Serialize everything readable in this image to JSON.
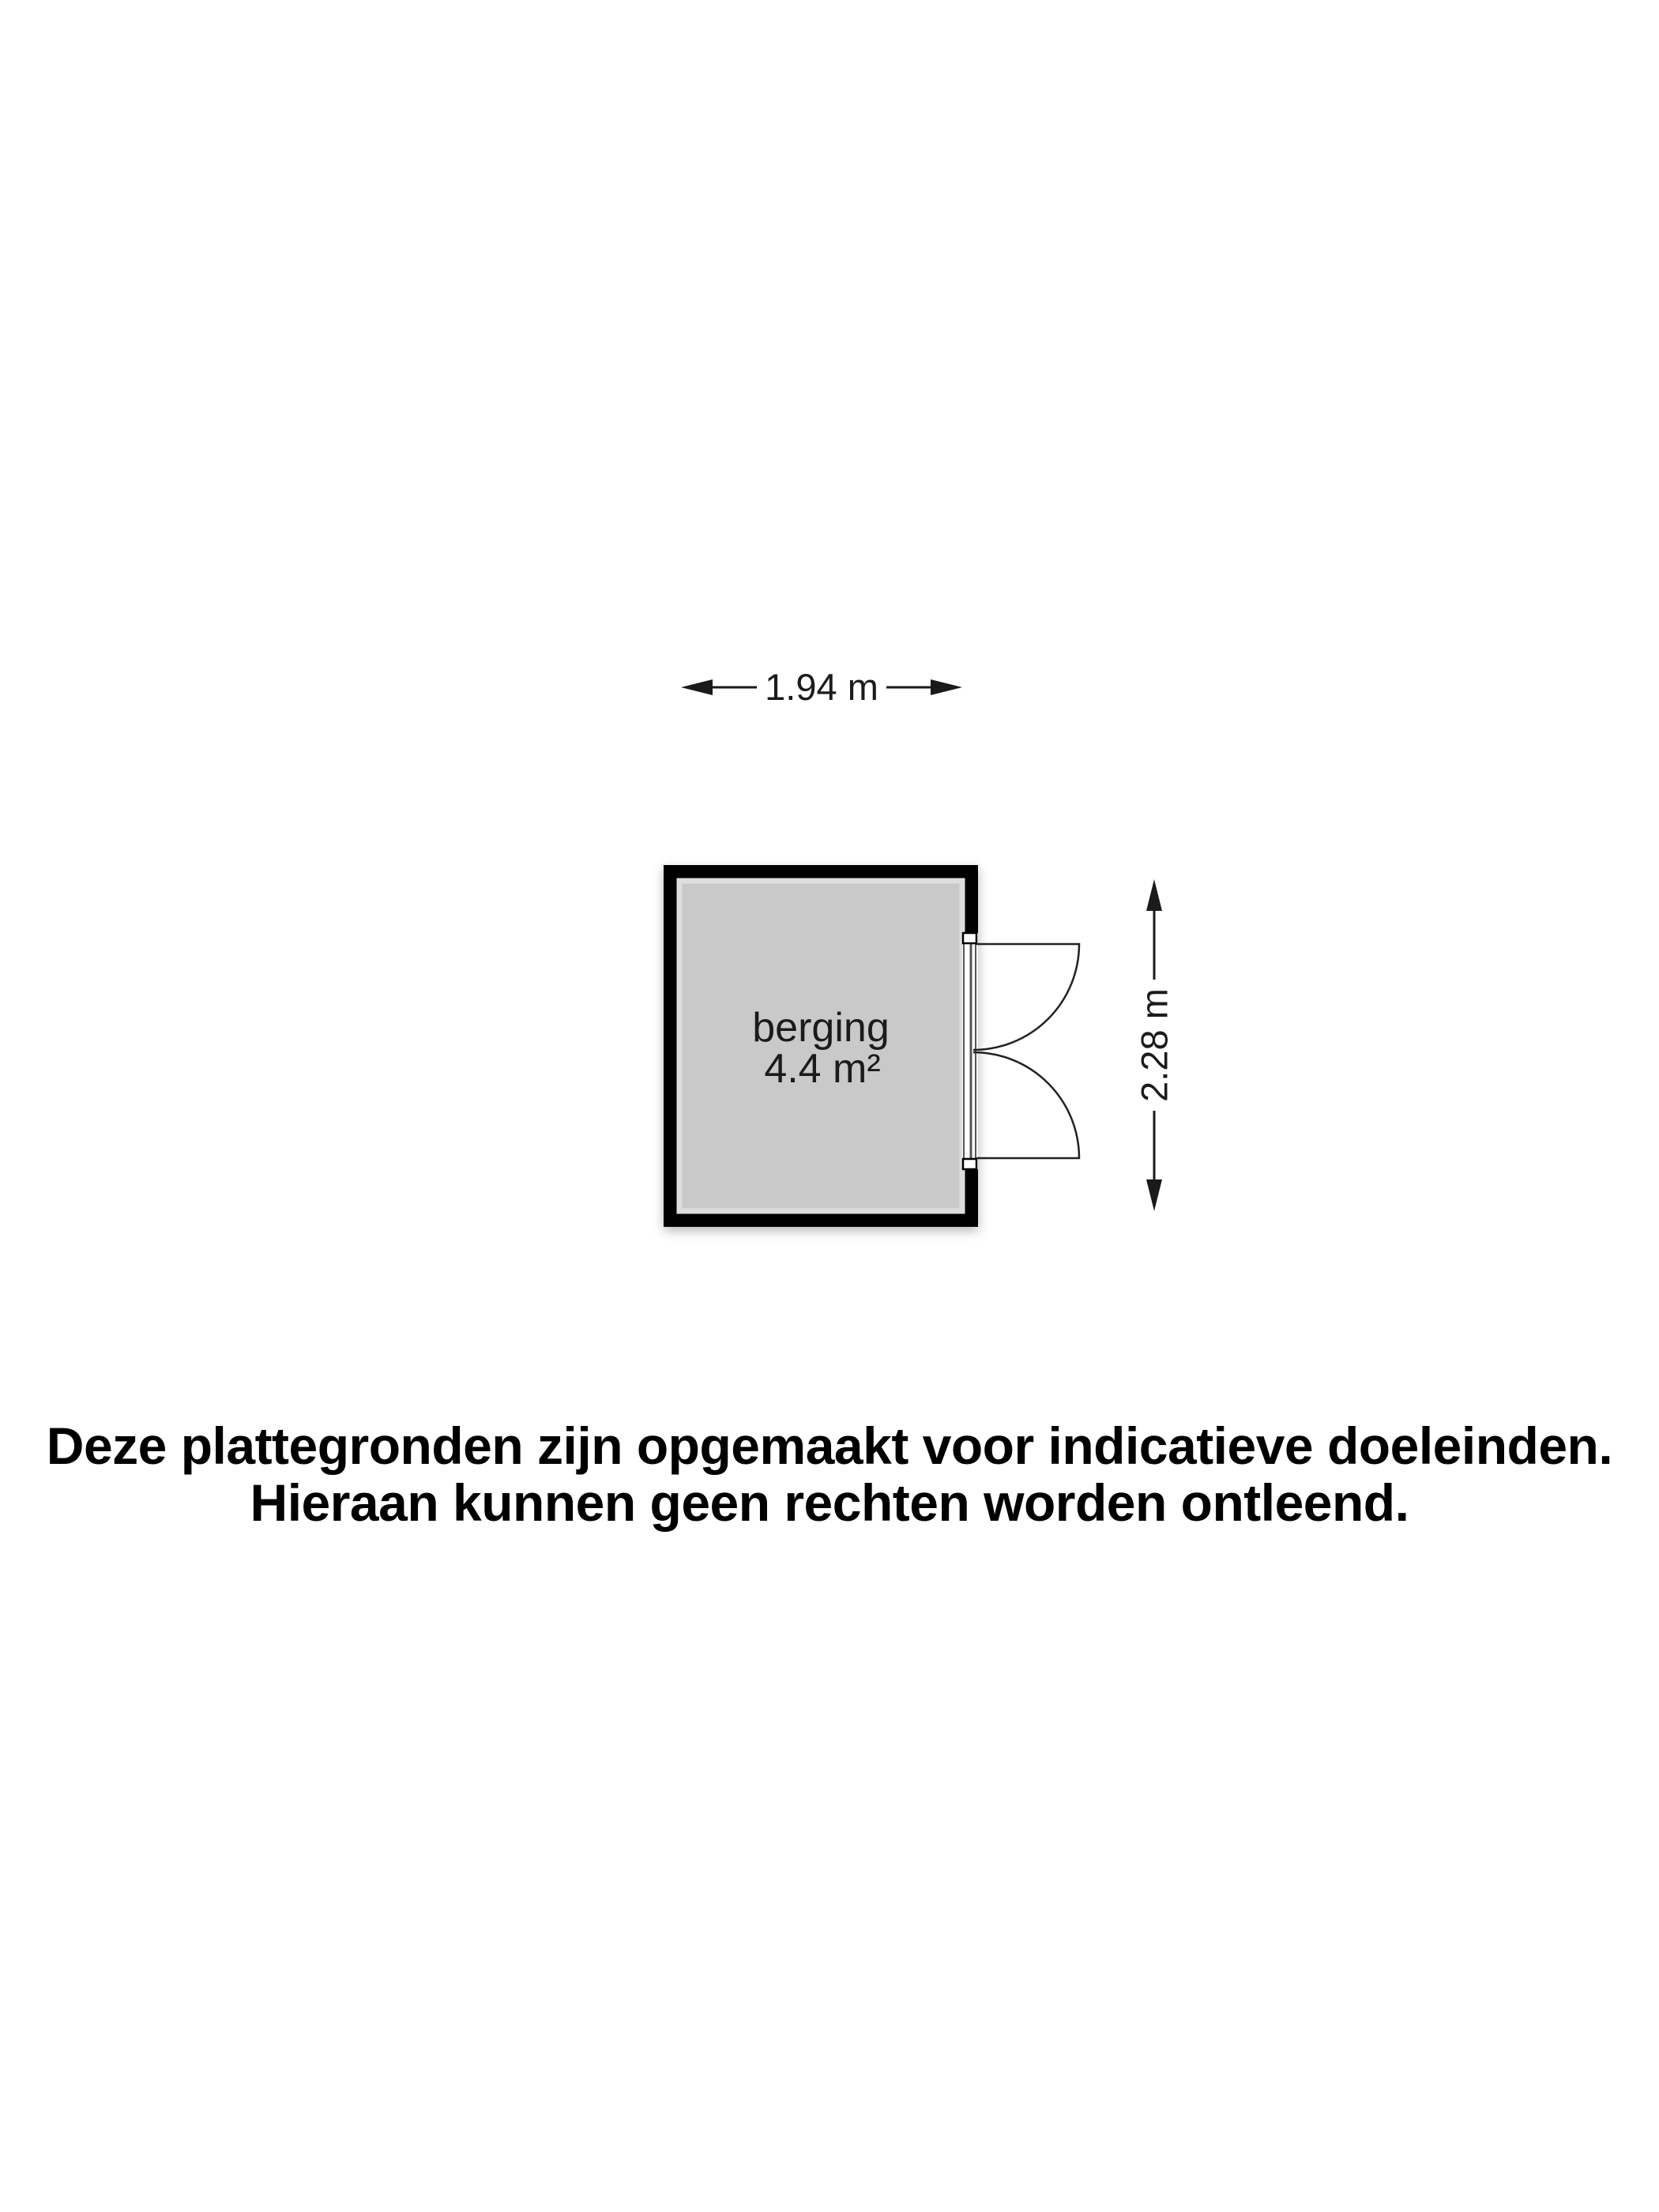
{
  "floorplan": {
    "room_label": "berging",
    "room_area": "4.4 m²",
    "width_dimension": "1.94 m",
    "height_dimension": "2.28 m",
    "icons": {
      "width_dimension": [
        "arrow-left-icon",
        "arrow-right-icon"
      ],
      "height_dimension": [
        "arrow-up-icon",
        "arrow-down-icon"
      ],
      "door": "double-door-swing-icon"
    },
    "colors": {
      "background": "#ffffff",
      "wall": "#000000",
      "floor": "#c9c9c9",
      "door_stroke": "#222222",
      "dimension": "#1a1a1a"
    }
  },
  "disclaimer": {
    "line1": "Deze plattegronden zijn opgemaakt voor indicatieve doeleinden.",
    "line2": "Hieraan kunnen geen rechten worden ontleend."
  }
}
